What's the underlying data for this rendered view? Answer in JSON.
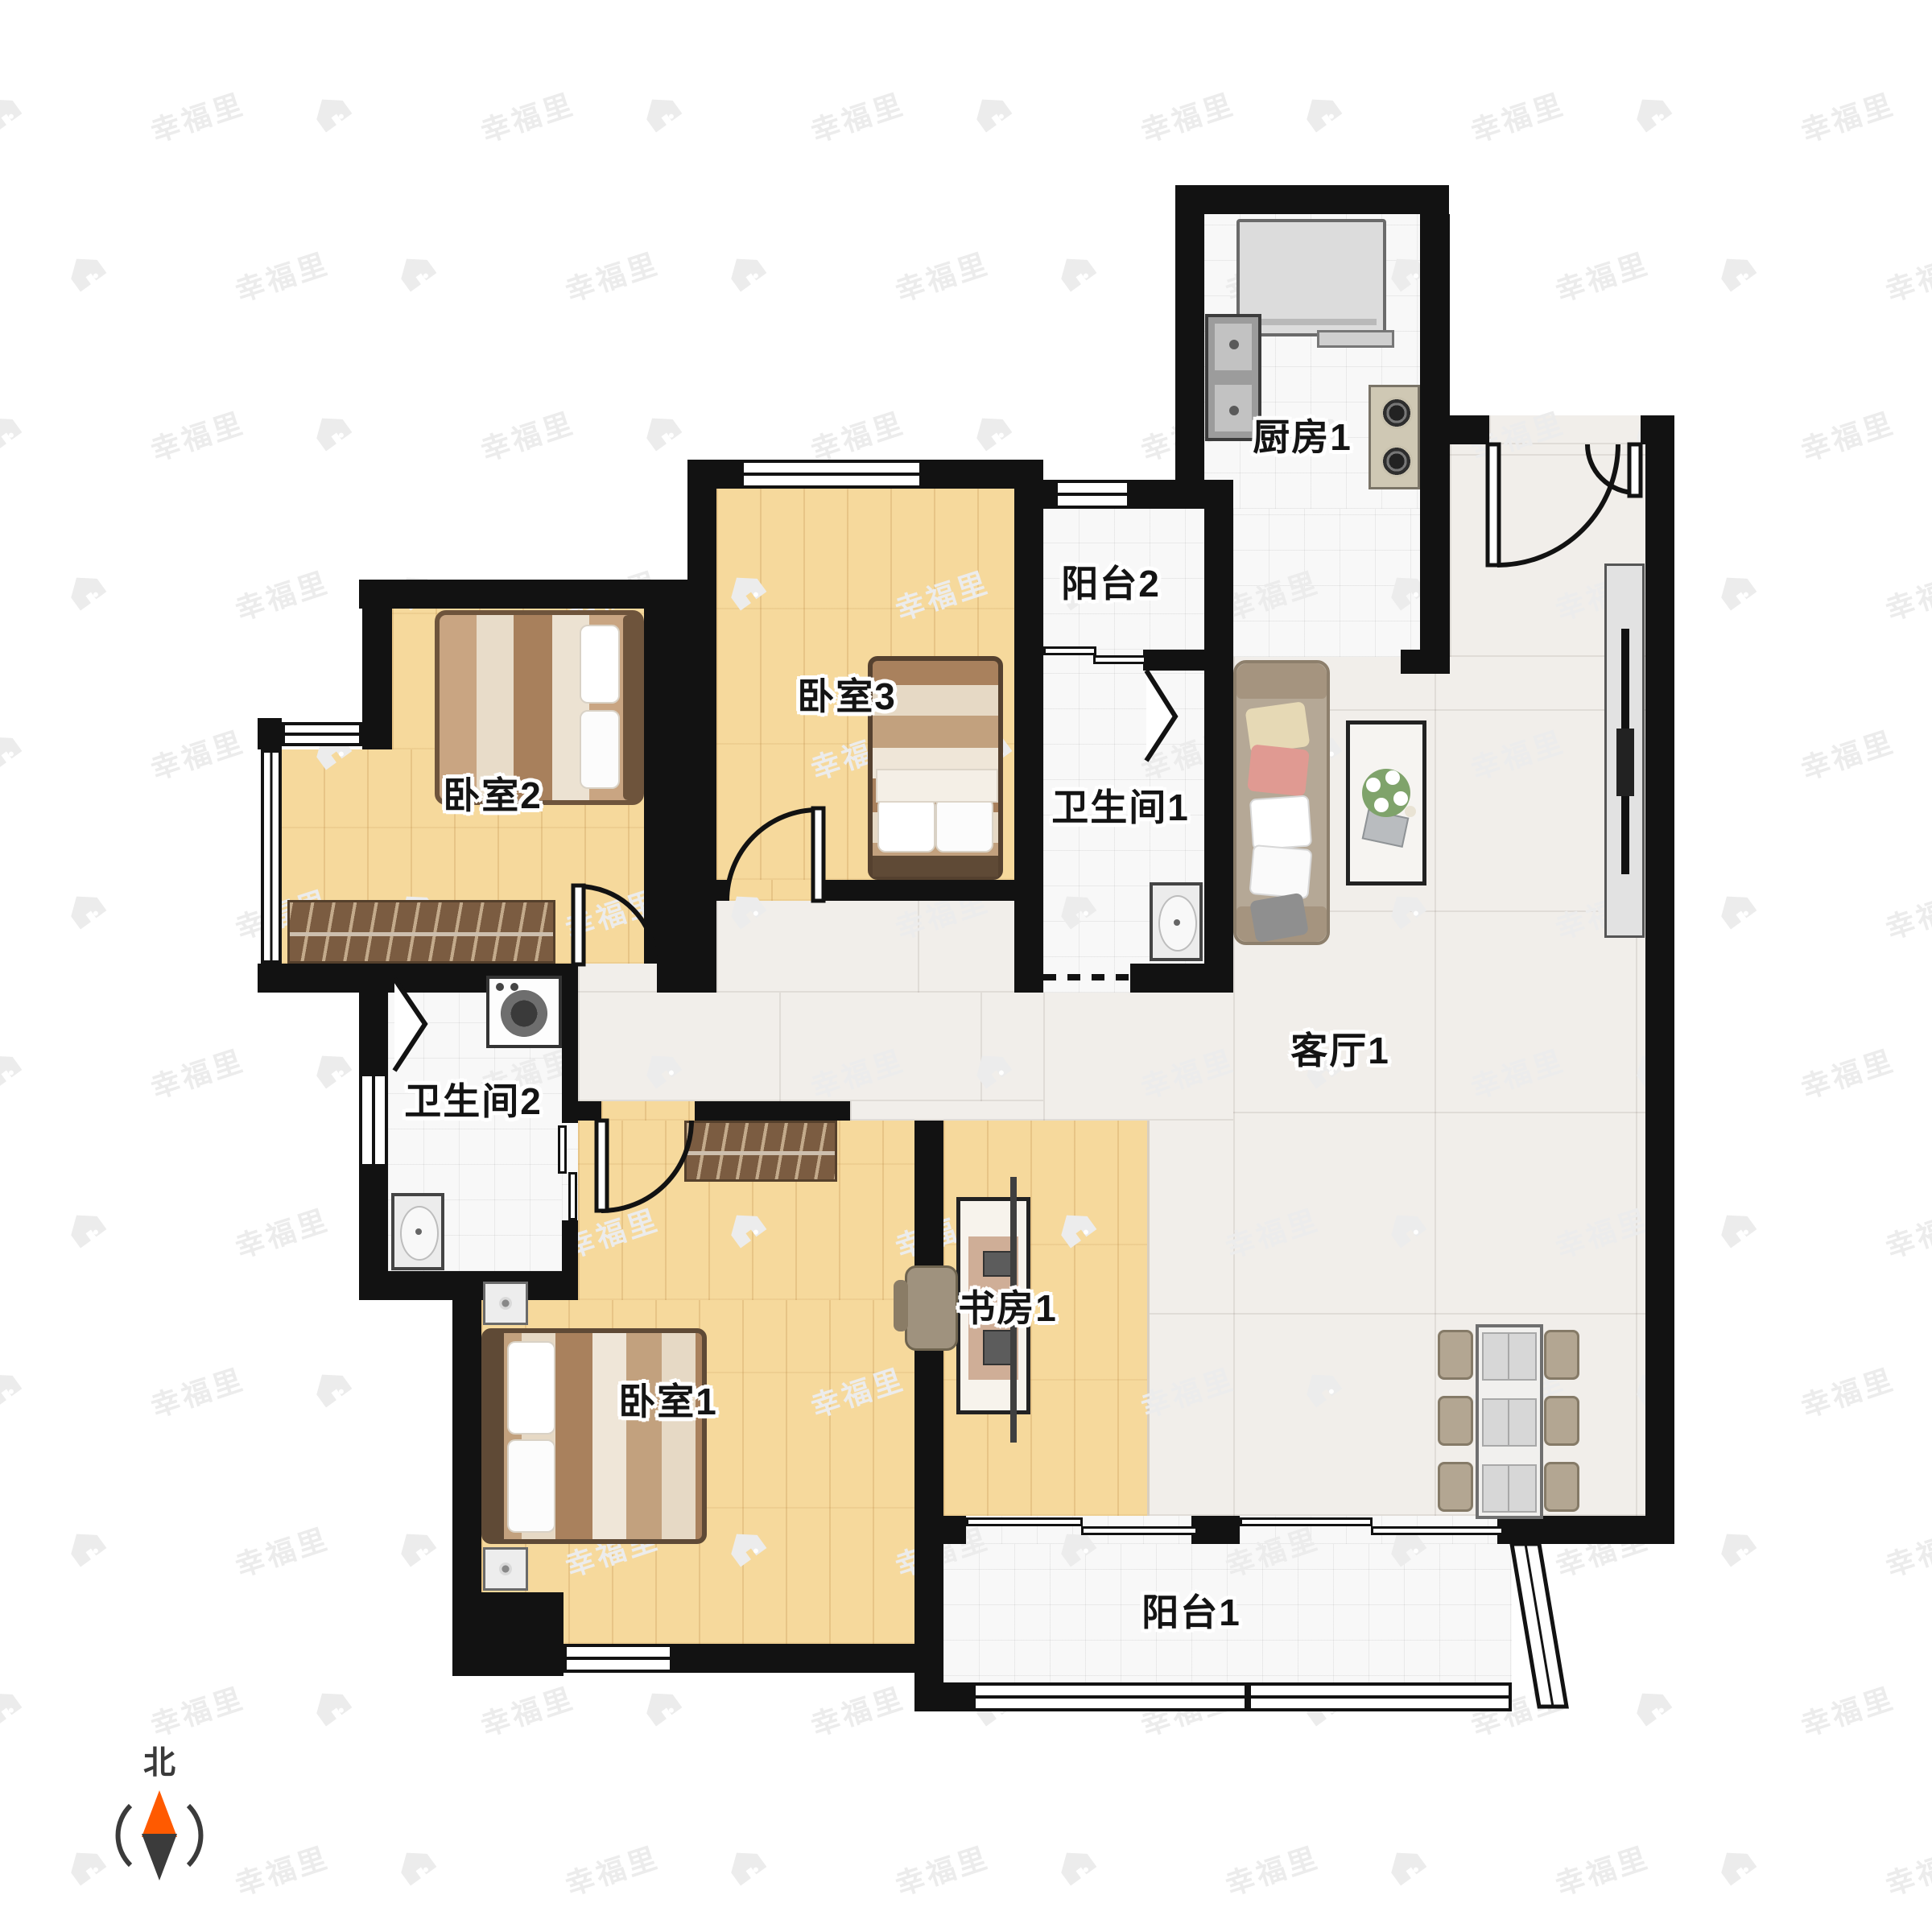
{
  "plan": {
    "rooms": [
      {
        "id": "kitchen",
        "label": "厨房1"
      },
      {
        "id": "balcony2",
        "label": "阳台2"
      },
      {
        "id": "bath1",
        "label": "卫生间1"
      },
      {
        "id": "living",
        "label": "客厅1"
      },
      {
        "id": "bedroom2",
        "label": "卧室2"
      },
      {
        "id": "bedroom3",
        "label": "卧室3"
      },
      {
        "id": "bath2",
        "label": "卫生间2"
      },
      {
        "id": "study",
        "label": "书房1"
      },
      {
        "id": "bedroom1",
        "label": "卧室1"
      },
      {
        "id": "balcony1",
        "label": "阳台1"
      }
    ],
    "compass": {
      "label": "北",
      "needle_north_color": "#ff5a00",
      "needle_south_color": "#3b3b3b"
    },
    "watermark": {
      "text": "幸福里"
    },
    "colors": {
      "wall": "#121212",
      "wood_floor": "#f6d99c",
      "marble_floor": "#f1eeea",
      "tile_floor": "#f8f8f8"
    }
  }
}
